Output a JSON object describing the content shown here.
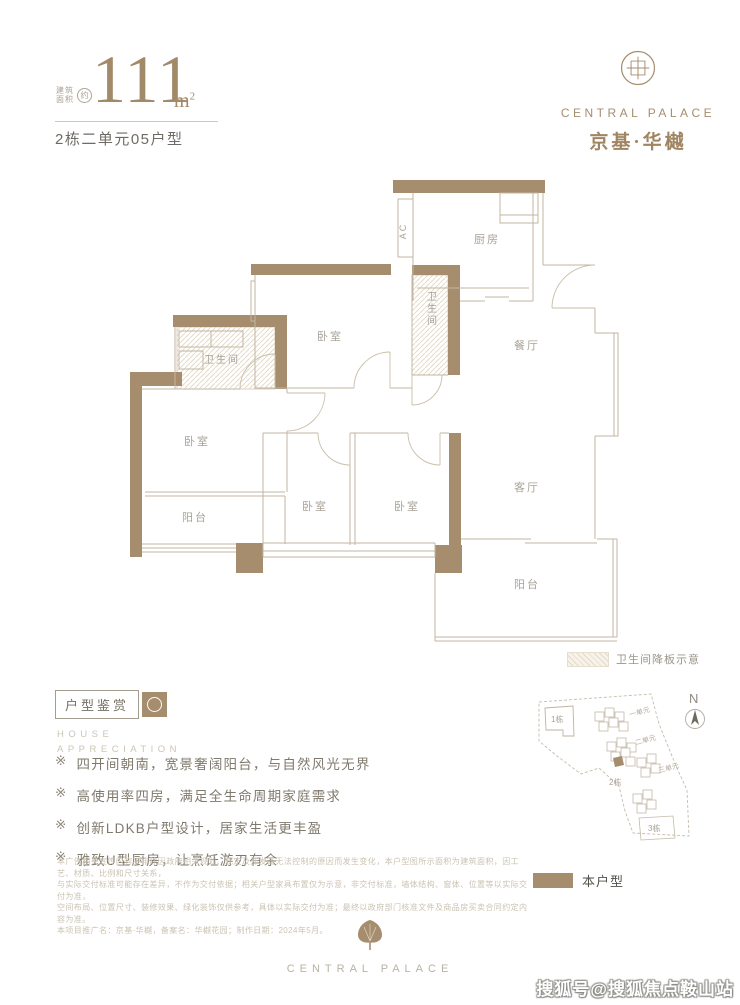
{
  "header": {
    "area_label_line1": "建筑",
    "area_label_line2": "面积",
    "area_approx_badge": "约",
    "area_value": "111",
    "area_unit_base": "m",
    "area_unit_sup": "2",
    "unit_info": "2栋二单元05户型"
  },
  "brand": {
    "name_en": "CENTRAL PALACE",
    "name_cn": "京基·华樾"
  },
  "floorplan": {
    "labels": {
      "kitchen": "厨房",
      "dining": "餐厅",
      "living": "客厅",
      "balcony_left": "阳台",
      "balcony_right": "阳台",
      "bedroom_top": "卧室",
      "bedroom_left": "卧室",
      "bedroom_mid_left": "卧室",
      "bedroom_mid_right": "卧室",
      "bath_left": "卫生间",
      "bath_mid": "卫生间",
      "ac": "AC"
    },
    "legend_sunken_slab": "卫生间降板示意"
  },
  "appreciation": {
    "title": "户型鉴赏",
    "subtitle_line1": "HOUSE",
    "subtitle_line2": "APPRECIATION",
    "marker": "※",
    "bullets": [
      "四开间朝南，宽景奢阔阳台，与自然风光无界",
      "高使用率四房，满足全生命周期家庭需求",
      "创新LDKB户型设计，居家生活更丰盈",
      "雅致U型厨房，让烹饪游刃有余"
    ]
  },
  "sitemap": {
    "compass": "N",
    "building_1": "1栋",
    "building_2": "2栋",
    "building_3": "3栋",
    "unit_1": "一单元",
    "unit_2": "二单元",
    "unit_3": "三单元",
    "legend_current_unit": "本户型"
  },
  "disclaimer": {
    "lines": [
      "本广告相关宣传内容不排除因政府相关规划、规定及开发商无法控制的原因而发生变化，本户型图所示面积为建筑面积，因工艺、材质、比例和尺寸关系，",
      "与实际交付标准可能存在差异，不作为交付依据；相关户型家具布置仅为示意，非交付标准，墙体结构、窗体、位置等以实际交付为准，",
      "空间布局、位置尺寸、装修效果、绿化装饰仅供参考，具体以实际交付为准；最终以政府部门核准文件及商品房买卖合同约定内容为准。",
      "本项目推广名：京基·华樾，备案名：华樾花园；制作日期：2024年5月。"
    ]
  },
  "footer": {
    "brand_en": "CENTRAL PALACE"
  },
  "watermark": "搜狐号@搜狐焦点鞍山站",
  "colors": {
    "wall_brown": "#A68D6E",
    "plan_line": "#C2B6A2",
    "label_gray": "#A9A399",
    "accent_brown": "#9F8561"
  }
}
